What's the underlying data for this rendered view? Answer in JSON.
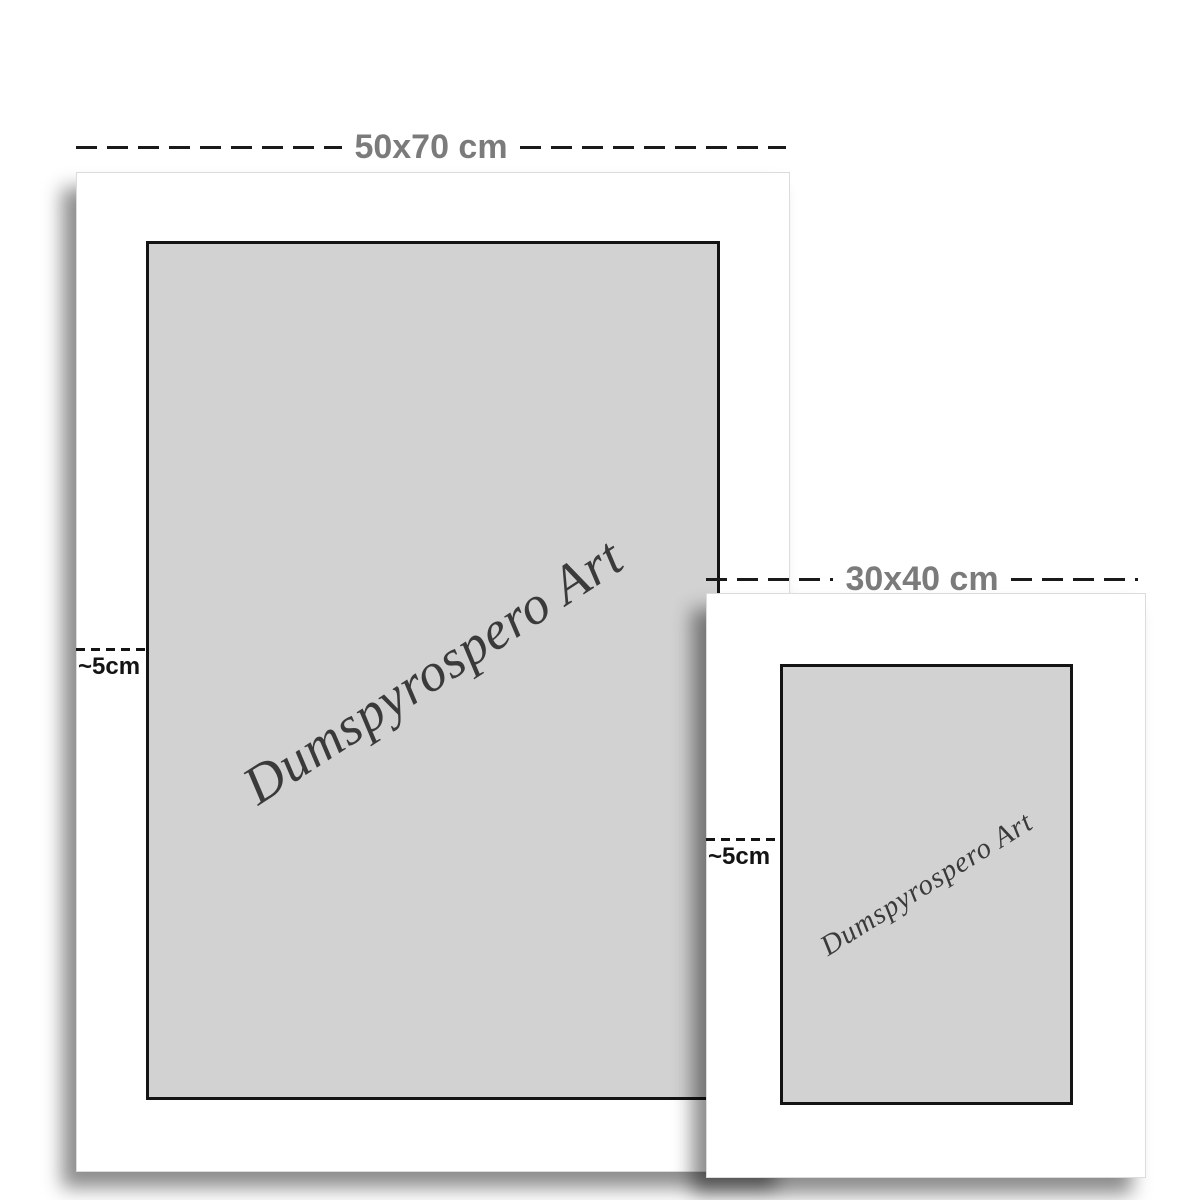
{
  "mockup": {
    "description": "Poster print size comparison mockup",
    "brand_text": "Dumspyrospero Art",
    "posters": [
      {
        "id": "large",
        "size_label": "50x70 cm",
        "margin_label": "~5cm"
      },
      {
        "id": "small",
        "size_label": "30x40 cm",
        "margin_label": "~5cm"
      }
    ],
    "colors": {
      "page_background": "#ffffff",
      "poster_background": "#ffffff",
      "artwork_background": "#d2d2d2",
      "artwork_border": "#141414",
      "size_label_color": "#7b7b7b",
      "margin_label_color": "#141414",
      "dash_color": "#1a1a1a",
      "brand_text_color": "#3a3a3a"
    }
  }
}
